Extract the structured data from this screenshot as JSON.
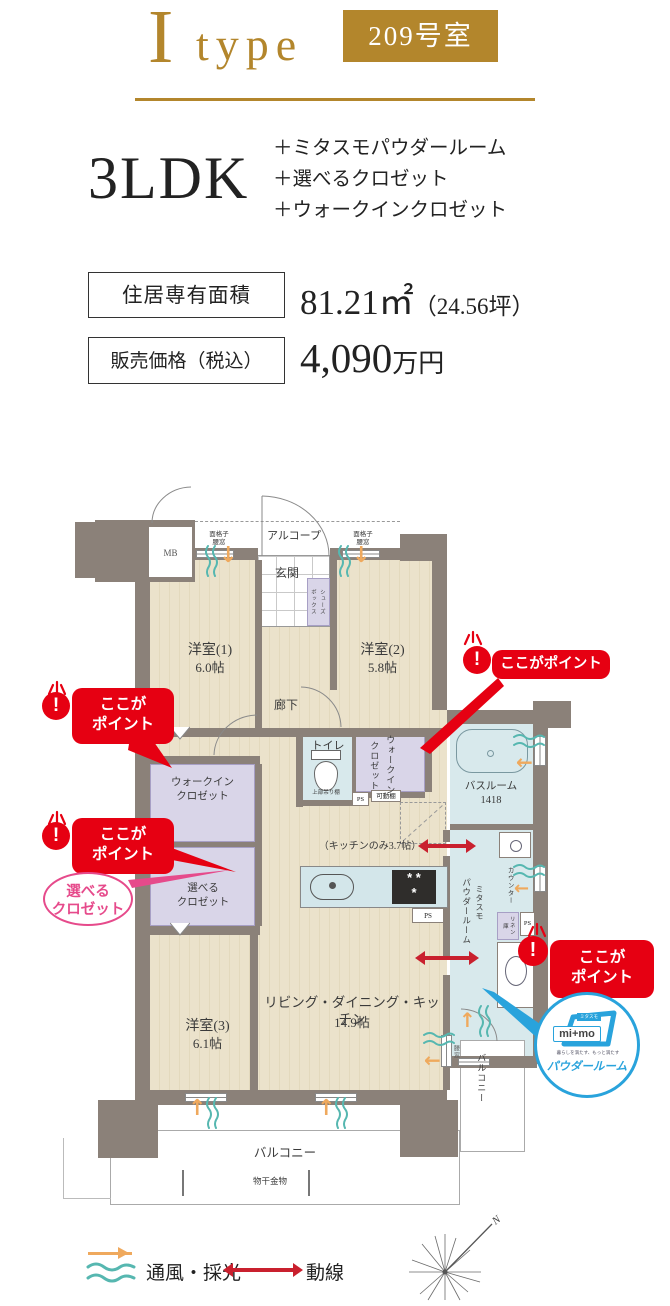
{
  "header": {
    "type_letter": "I",
    "type_word": "type",
    "room_no": "209号室"
  },
  "summary": {
    "layout": "3LDK",
    "features": [
      "＋ミタスモパウダールーム",
      "＋選べるクロゼット",
      "＋ウォークインクロゼット"
    ]
  },
  "specs": {
    "area_label": "住居専有面積",
    "area_value": "81.21㎡",
    "area_sub": "（24.56坪）",
    "price_label": "販売価格（税込）",
    "price_value": "4,090",
    "price_unit": "万円"
  },
  "plan": {
    "mb": "MB",
    "alcove": "アルコープ",
    "entrance": "玄関",
    "grille_line1": "面格子",
    "grille_line2": "腰窓",
    "shoes_line1": "シューズ",
    "shoes_line2": "ボックス",
    "bedroom1": "洋室(1)",
    "bedroom1_size": "6.0帖",
    "bedroom2": "洋室(2)",
    "bedroom2_size": "5.8帖",
    "bedroom3": "洋室(3)",
    "bedroom3_size": "6.1帖",
    "corridor": "廊下",
    "toilet": "トイレ",
    "toilet_shelf": "上部吊り棚",
    "ps": "PS",
    "movable_shelf": "可動棚",
    "wic_line1": "ウォークイン",
    "wic_line2": "クロゼット",
    "closet_line1": "選べる",
    "closet_line2": "クロゼット",
    "bathroom": "バスルーム",
    "bathroom_size": "1418",
    "kitchen_note": "（キッチンのみ3.7帖）",
    "ldk": "リビング・ダイニング・キッチン",
    "ldk_size": "14.9帖",
    "powder_brand": "ミタスモ",
    "powder_name": "パウダールーム",
    "counter": "カウンター",
    "linen": "リネン庫",
    "window_label": "腰窓",
    "balcony": "バルコニー",
    "laundry": "物干金物"
  },
  "badges": {
    "point": "ここがポイント",
    "point_l1": "ここが",
    "point_l2": "ポイント",
    "closet_l1": "選べる",
    "closet_l2": "クロゼット",
    "mimo_small": "ミタスモ",
    "mimo_brand": "mi+mo",
    "mimo_tagline": "暮らしを満たす、もっと満たす",
    "mimo_label": "パウダールーム"
  },
  "legend": {
    "airflow": "通風・採光",
    "flow": "動線",
    "north": "N"
  },
  "colors": {
    "gold": "#b3862c",
    "red": "#e60012",
    "pink": "#e64a8b",
    "blue": "#29a3dc",
    "teal": "#56b7b0",
    "orange": "#efa95d",
    "wall": "#8b8179",
    "arrow_red": "#c9202e"
  }
}
